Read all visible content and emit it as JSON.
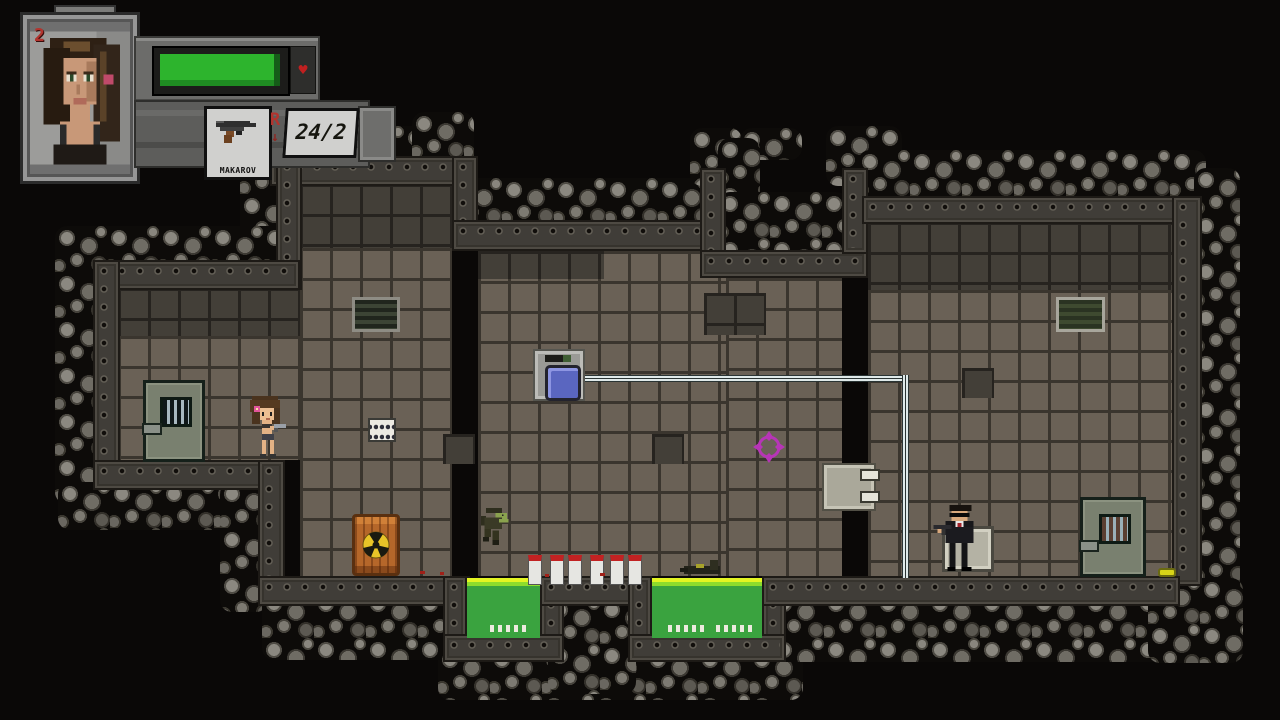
{
  "game": {
    "hud": {
      "lives": "2",
      "weapon_name": "MAKAROV",
      "ammo": "24/2",
      "reload_indicator": "R",
      "reload_arrow": "↓",
      "health_percent": 95
    },
    "colors": {
      "health_bar_green": "#2db42d",
      "lives_red": "#b2342e",
      "acid_pool_green": "#3aa33f",
      "acid_edge_yellow": "#e4f522",
      "crosshair_magenta": "#b735b7",
      "barrel_orange": "#b5672a",
      "button_blue": "#5a66c0",
      "heart_red": "#c02020"
    },
    "entities": [
      {
        "name": "player-girl"
      },
      {
        "name": "enemy-agent"
      },
      {
        "name": "zombie-soldier"
      },
      {
        "name": "corpse"
      },
      {
        "name": "radioactive-barrel"
      },
      {
        "name": "bottles",
        "count": 6
      },
      {
        "name": "prison-door-left"
      },
      {
        "name": "prison-door-right"
      },
      {
        "name": "acid-pool-left"
      },
      {
        "name": "acid-pool-right"
      },
      {
        "name": "wall-button"
      },
      {
        "name": "wall-hatch"
      },
      {
        "name": "keypad"
      },
      {
        "name": "wall-vent-left"
      },
      {
        "name": "wall-vent-right"
      },
      {
        "name": "ammo-pickup"
      },
      {
        "name": "crosshair-cursor"
      }
    ]
  }
}
